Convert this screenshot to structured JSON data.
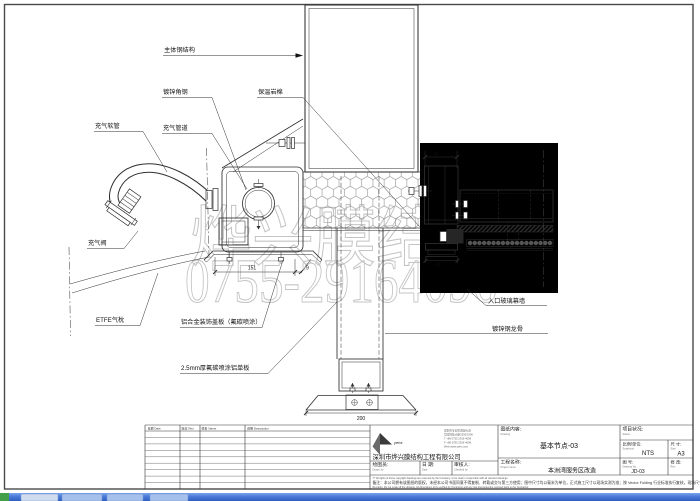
{
  "colors": {
    "frame": "#4a4a4a",
    "line": "#2f2f2f",
    "watermark": "#c4c4c4",
    "taskbar_top": "#7aa2ec",
    "taskbar_bottom": "#2f5ec0",
    "taskbar_start": "#44a048",
    "taskbar_button": "#a6c0ec"
  },
  "watermark": {
    "line1": "烨兴膜结构",
    "line2": "0755-29164096",
    "small": "s.com"
  },
  "annotations": {
    "main_steel": "主体钢结构",
    "galv_angle": "镀锌角钢",
    "rock_wool": "保温岩棉",
    "air_hose": "充气软管",
    "air_pipe": "充气管道",
    "air_valve": "充气阀",
    "etfe_cushion": "ETFE气枕",
    "alu_cover": "铝合金装饰盖板（氟碳喷涂）",
    "alu_panel": "2.5mm厚氟碳喷涂铝单板",
    "entrance_wall": "入口玻璃幕墙",
    "steel_keel": "镀锌钢龙骨"
  },
  "dimensions": {
    "plate_width": "151",
    "plate_offset": "9",
    "column_base": "200",
    "mullion_top": "60",
    "mullion_bottom": "62"
  },
  "title_block": {
    "rev_headers": [
      "日期 Date",
      "版本 Rev.",
      "姓名 Name",
      "说明 Description"
    ],
    "company": {
      "logo": "yehx",
      "name": "深圳市烨兴膜结构工程有限公司",
      "address_lines": [
        "深圳市宝安区观澜大道",
        "华园科技大厦3305/3306",
        "T +86 0755 2916 4096",
        "F +86 0755 2916 4096",
        "Web www.yehx.com"
      ]
    },
    "fields": {
      "drawn_label": "绘图员:",
      "drawn_en": "Drawn by",
      "date_label": "日 期:",
      "date_en": "Date",
      "check_label": "审核人:",
      "check_en": "Checked by",
      "content_label": "图纸内容:",
      "content_en": "Drawing",
      "content_value": "基本节点-03",
      "project_label": "工程名称:",
      "project_en": "Project name",
      "project_value": "本洲湾服务区改造",
      "status_label": "项目状况:",
      "status_en": "Status",
      "scale_label": "比例/单位:",
      "scale_en": "Scale/unit",
      "scale_value": "NTS",
      "size_label": "尺 寸:",
      "size_en": "Size",
      "size_value": "A3",
      "dwg_label": "图 号:",
      "dwg_en": "Drawing No.",
      "dwg_value": "JD-03",
      "rev_label": "修 改:",
      "rev_en": "Rev."
    },
    "notes": [
      "©* All rights of these copyright drawings are reserved by the Company; to be read in conjunction with all relevant drawings.",
      "备注：本公司拥有该图纸的版权，未经本公司书面同意不得复制、转载或交与第三方使用；图中尺寸均以毫米为单位，正式施工尺寸以现场实测为准；按 Vector Folding 行业标准执行复核，现场尺寸需要承包商确认。",
      "Remarks: Do not scale off the drawing. All dimensions to be verified by Contractor and any site discrepancies reported back to the Contractor."
    ]
  }
}
